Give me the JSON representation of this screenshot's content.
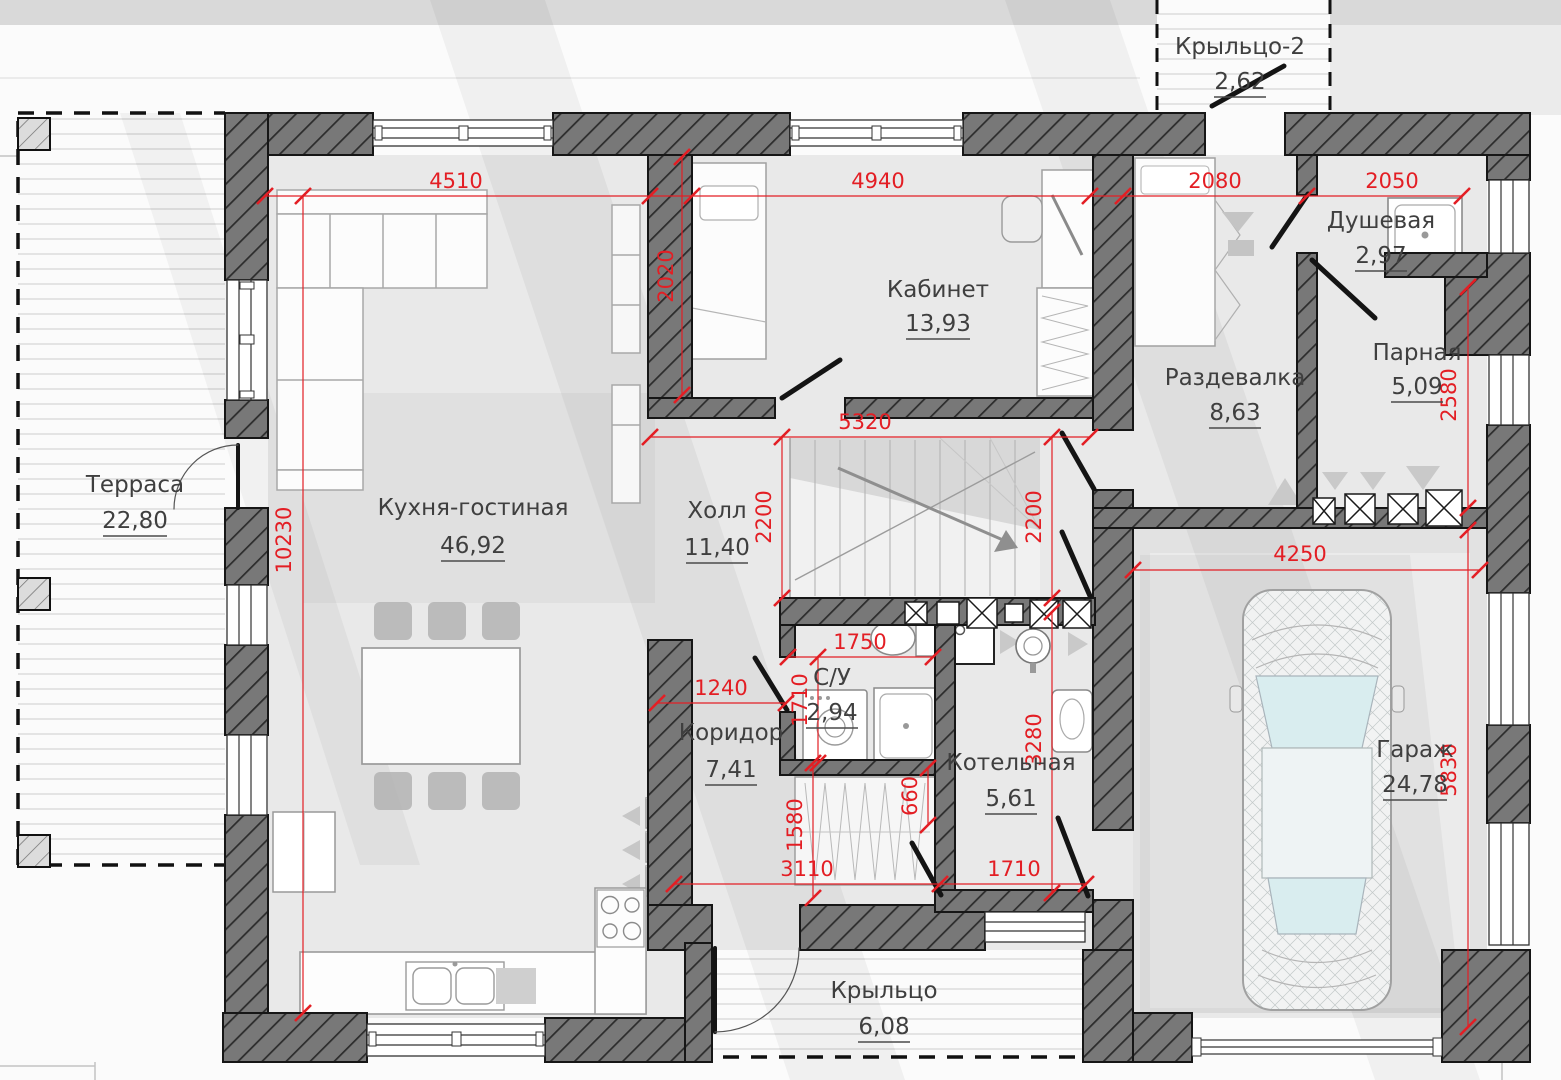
{
  "rooms": {
    "terrace": {
      "name": "Терраса",
      "area": "22,80"
    },
    "kitchen": {
      "name": "Кухня-гостиная",
      "area": "46,92"
    },
    "cabinet": {
      "name": "Кабинет",
      "area": "13,93"
    },
    "hall": {
      "name": "Холл",
      "area": "11,40"
    },
    "corridor": {
      "name": "Коридор",
      "area": "7,41"
    },
    "wc": {
      "name": "С/У",
      "area": "2,94"
    },
    "boiler": {
      "name": "Котельная",
      "area": "5,61"
    },
    "dressing": {
      "name": "Раздевалка",
      "area": "8,63"
    },
    "shower": {
      "name": "Душевая",
      "area": "2,97"
    },
    "sauna": {
      "name": "Парная",
      "area": "5,09"
    },
    "garage": {
      "name": "Гараж",
      "area": "24,78"
    },
    "porch": {
      "name": "Крыльцо",
      "area": "6,08"
    },
    "porch2": {
      "name": "Крыльцо-2",
      "area": "2,62"
    }
  },
  "dims": {
    "kitchen_w": "4510",
    "cabinet_w": "4940",
    "dressing_w": "2080",
    "shower_w": "2050",
    "cabinet_d": "2020",
    "hall_w": "5320",
    "stair_l": "2200",
    "stair_r": "2200",
    "sauna_h": "2580",
    "house_d": "10230",
    "garage_w": "4250",
    "wc_w": "1750",
    "corridor_w": "1240",
    "wc_d": "1710",
    "boiler_d": "3280",
    "corridor_d": "1580",
    "closet_d": "660",
    "porch_w1": "3110",
    "porch_w2": "1710",
    "garage_d": "5830"
  },
  "colors": {
    "dimension": "#e31e24",
    "walls": "#757575",
    "labels": "#3f3f3f"
  }
}
